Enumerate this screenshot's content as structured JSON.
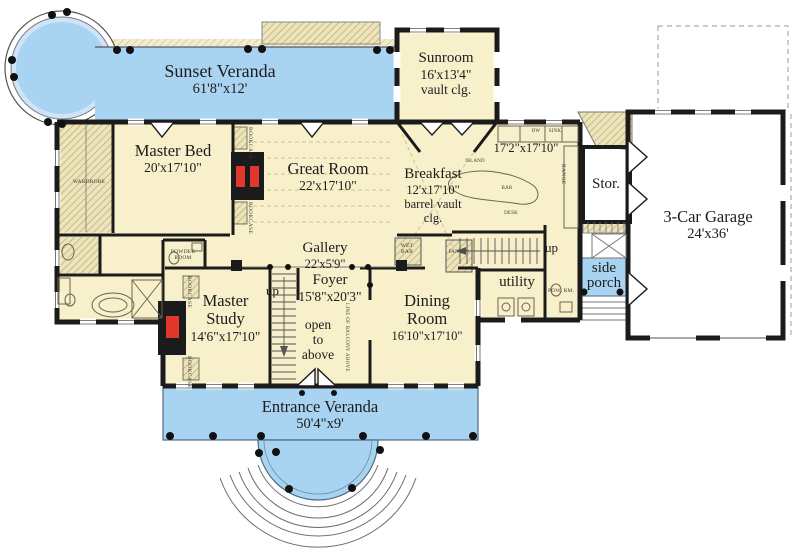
{
  "colors": {
    "porch_blue": "#a8d3f1",
    "interior_cream": "#f7f0ca",
    "wall_black": "#1b1b1b",
    "fireplace_red": "#e0362b",
    "hatch_tan": "#b9ac7e"
  },
  "plan": {
    "sunset_veranda": {
      "name": "Sunset Veranda",
      "dims": "61'8\"x12'"
    },
    "sunroom": {
      "name": "Sunroom",
      "dims": "16'x13'4\"",
      "note": "vault clg."
    },
    "master_bed": {
      "name": "Master Bed",
      "dims": "20'x17'10\""
    },
    "great_room": {
      "name": "Great Room",
      "dims": "22'x17'10\""
    },
    "breakfast": {
      "name": "Breakfast",
      "dims": "12'x17'10\"",
      "note1": "barrel vault",
      "note2": "clg."
    },
    "kitchen": {
      "dims": "17'2\"x17'10\""
    },
    "storage": {
      "name": "Stor."
    },
    "garage": {
      "name": "3-Car Garage",
      "dims": "24'x36'"
    },
    "gallery": {
      "name": "Gallery",
      "dims": "22'x5'9\""
    },
    "foyer": {
      "name": "Foyer",
      "dims": "15'8\"x20'3\""
    },
    "open_to_above": {
      "line1": "open",
      "line2": "to",
      "line3": "above"
    },
    "master_study": {
      "line1": "Master",
      "line2": "Study",
      "dims": "14'6\"x17'10\""
    },
    "dining": {
      "line1": "Dining",
      "line2": "Room",
      "dims": "16'10\"x17'10\""
    },
    "utility": {
      "name": "utility"
    },
    "side_porch": {
      "line1": "side",
      "line2": "porch"
    },
    "entrance_veranda": {
      "name": "Entrance Veranda",
      "dims": "50'4\"x9'"
    },
    "labels": {
      "up": "up",
      "wet_bar": "WET BAR",
      "pantry": "PANTRY",
      "powder_room": "POWDER ROOM",
      "wardrobe": "WARDROBE",
      "pow_rm": "POW. RM.",
      "bookcase": "BOOKCASE",
      "balcony": "LINE OF BALCONY ABOVE",
      "island": "ISLAND",
      "bar": "BAR",
      "range": "RANGE",
      "dw": "DW",
      "sink": "SINK",
      "desk": "DESK"
    }
  }
}
